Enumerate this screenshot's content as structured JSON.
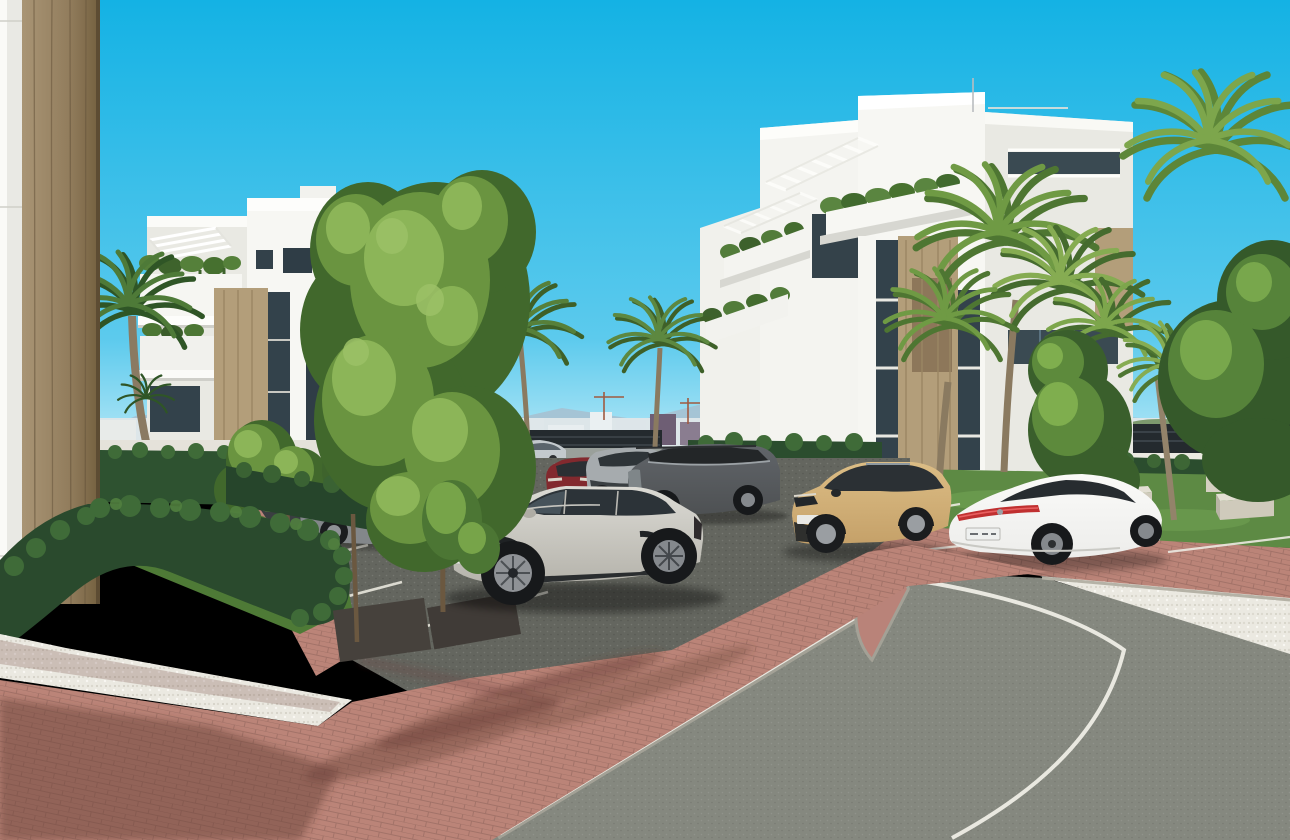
{
  "meta": {
    "kind": "3d-architectural-render",
    "subject": "Modern white residential apartment complex with landscaped parking lot, palm trees, hedges and a curving asphalt road",
    "width_px": 1290,
    "height_px": 840
  },
  "palette": {
    "sky_top": "#14b2e4",
    "sky_mid": "#5ccaed",
    "sky_horizon": "#c6edf8",
    "mountain": "#a7c0cf",
    "city_base": "#dde6e9",
    "wall_white": "#f7f7f3",
    "wall_shade": "#e9e9e3",
    "wood": "#b39e7a",
    "wood_dark": "#8d775a",
    "glass": "#33424b",
    "foliage_light": "#8cb558",
    "foliage": "#6a9440",
    "foliage_dark": "#41682c",
    "palm": "#4e7a38",
    "palm_dark": "#2f5526",
    "hedge": "#26452b",
    "hedge_light": "#3f6b38",
    "lawn": "#4e7a36",
    "grass": "#5d8a44",
    "parking_asphalt": "#64665f",
    "road_asphalt": "#85887f",
    "brick": "#bb8478",
    "brick_shadow": "#6a4038",
    "gravel": "#ebe9e1",
    "curb": "#a3a196",
    "line_white": "#eceae2",
    "fence_dark": "#242a2e",
    "trunk": "#7c684f",
    "concrete": "#d9d5c9",
    "column_wood": "#9b8768",
    "tail_red": "#c03030"
  },
  "scene": {
    "sky": {
      "top": "#14b2e4",
      "mid": "#5ccaed",
      "horizon": "#c6edf8"
    },
    "background": {
      "mountains": "#a7c0cf",
      "city_strip": "low white city skyline with two construction cranes",
      "boundary_wall": "#eceae4",
      "fence": "#242a2e"
    },
    "buildings": [
      {
        "id": "left-apartment-building",
        "style": "white modern block, rooftop pergola slats, balconies with cascading plants, wood accent panel",
        "wall": "#f6f6f2"
      },
      {
        "id": "right-apartment-building",
        "style": "white modern block, two rooftop pergolas, hanging balcony greenery, wood slat panels, full-height glazing",
        "wall": "#f8f8f4"
      },
      {
        "id": "foreground-corner-column",
        "style": "wood-clad structural column with white wall strip at image left edge",
        "wall": "#9b8768"
      }
    ],
    "vehicles": [
      {
        "id": "foreground-suv",
        "type": "electric SUV",
        "color": "#b5b3ab",
        "pose": "3/4 front, facing left, front parking row"
      },
      {
        "id": "white-fastback-sedan",
        "type": "luxury fastback",
        "color": "#ededeb",
        "pose": "rear 3/4, parked right of center",
        "taillight": "#c03030"
      },
      {
        "id": "tan-compact-suv",
        "type": "compact crossover",
        "color": "#c5a169",
        "pose": "3/4 front, facing left"
      },
      {
        "id": "dark-grey-suv",
        "type": "large SUV",
        "color": "#4e5153",
        "pose": "side view, back row"
      },
      {
        "id": "silver-suv",
        "type": "crossover",
        "color": "#a6abae",
        "pose": "front view, back row"
      },
      {
        "id": "red-suv",
        "type": "crossover",
        "color": "#82292e",
        "pose": "front view, back row"
      },
      {
        "id": "grey-sedan",
        "type": "sedan",
        "color": "#83878a",
        "pose": "side view behind saplings"
      },
      {
        "id": "dark-sedan",
        "type": "sedan",
        "color": "#3a3e41",
        "pose": "partially hidden by hedge"
      },
      {
        "id": "distant-moving-car",
        "type": "sedan",
        "color": "#c3c9cd",
        "pose": "driving on road behind hedge"
      }
    ],
    "landscaping": {
      "lawn": "#4e7a36",
      "hedges": "clipped boxwood runs framing lawn, pool deck, parking and right walkway",
      "deciduous_trees": 3,
      "saplings": 2,
      "fan_palms": 6,
      "pygmy_date_palm": 1,
      "benches": 2,
      "planter": "#d5d0c2"
    },
    "pool_area": {
      "parasol": "white",
      "sun_loungers": 3,
      "railing": "dark metal vertical bars"
    },
    "hardscape": {
      "parking_surface": "dark asphalt with white stall lines",
      "walkways": "red clay paver herringbone",
      "gravel_margins": "white pebble strips",
      "road": "asphalt with white edge line and curved white lane line"
    }
  }
}
